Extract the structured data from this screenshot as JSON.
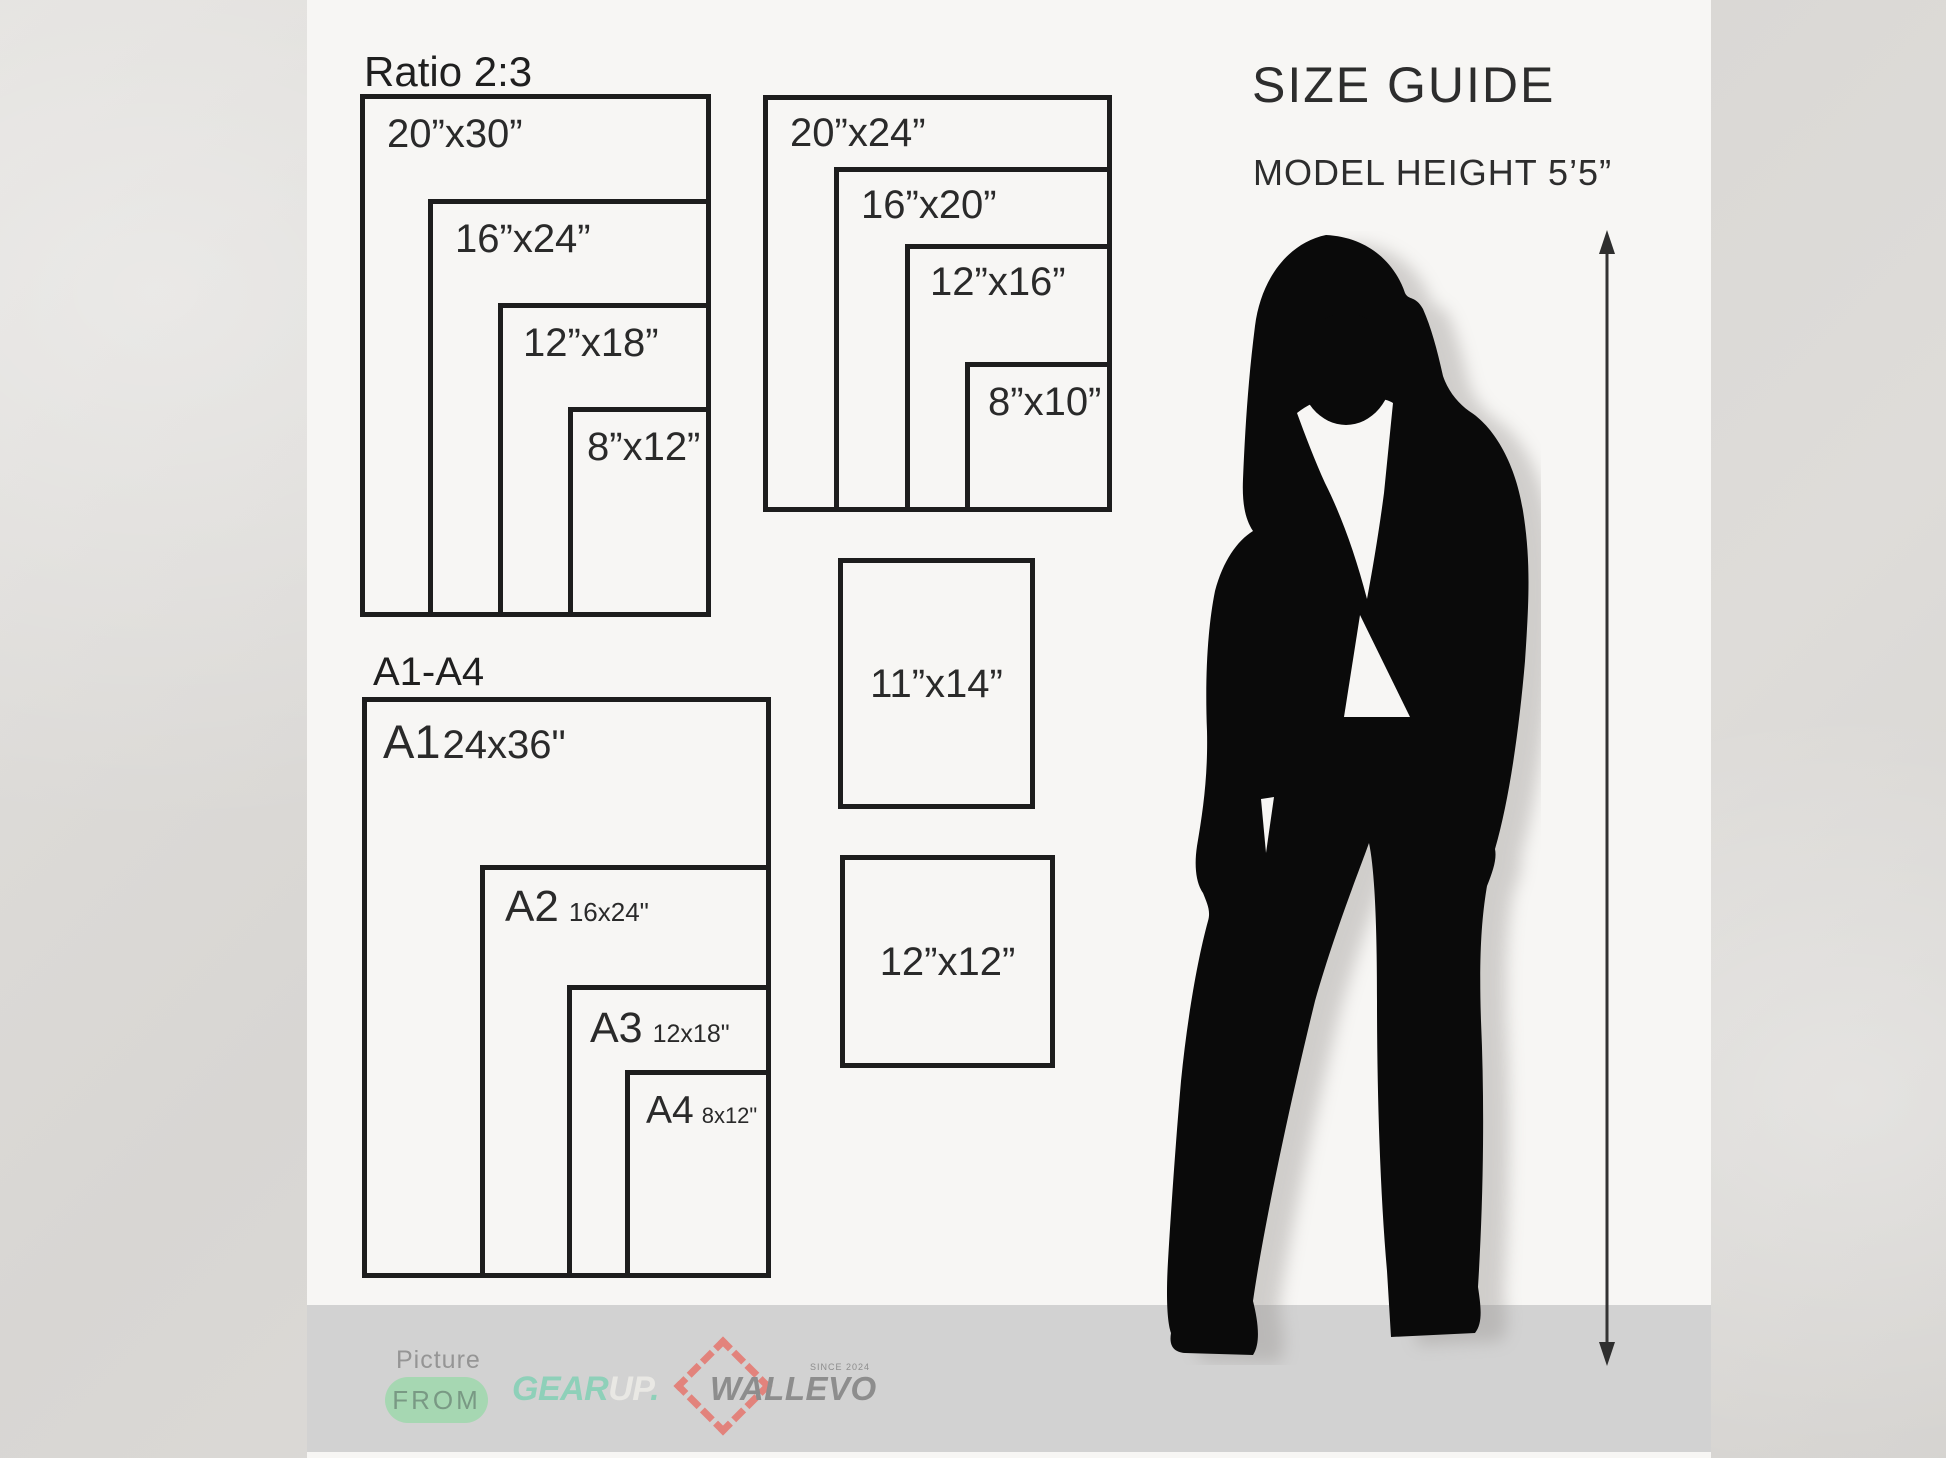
{
  "header": {
    "title": "SIZE GUIDE",
    "model_height": "MODEL HEIGHT 5’5”"
  },
  "ratio23": {
    "label": "Ratio 2:3",
    "boxes": [
      {
        "label": "20”x30”"
      },
      {
        "label": "16”x24”"
      },
      {
        "label": "12”x18”"
      },
      {
        "label": "8”x12”"
      }
    ]
  },
  "standard": {
    "boxes": [
      {
        "label": "20”x24”"
      },
      {
        "label": "16”x20”"
      },
      {
        "label": "12”x16”"
      },
      {
        "label": "8”x10”"
      }
    ]
  },
  "singles": {
    "boxes": [
      {
        "label": "11”x14”"
      },
      {
        "label": "12”x12”"
      }
    ]
  },
  "a_series": {
    "label": "A1-A4",
    "boxes": [
      {
        "name": "A1",
        "dim": "24x36\""
      },
      {
        "name": "A2",
        "dim": "16x24\""
      },
      {
        "name": "A3",
        "dim": "12x18\""
      },
      {
        "name": "A4",
        "dim": "8x12\""
      }
    ]
  },
  "footer": {
    "picture_label": "Picture",
    "from_badge": "FROM",
    "gear": "GEAR",
    "up": "UP",
    "dot": ".",
    "wallevo": "WALLEVO",
    "since": "SINCE 2024"
  },
  "colors": {
    "footer_band": "#d2d2d2",
    "pill_green": "#a6d7b2",
    "gear_mint": "#8ed0b9",
    "wallevo_coral": "#e2837c",
    "ink": "#262626"
  }
}
